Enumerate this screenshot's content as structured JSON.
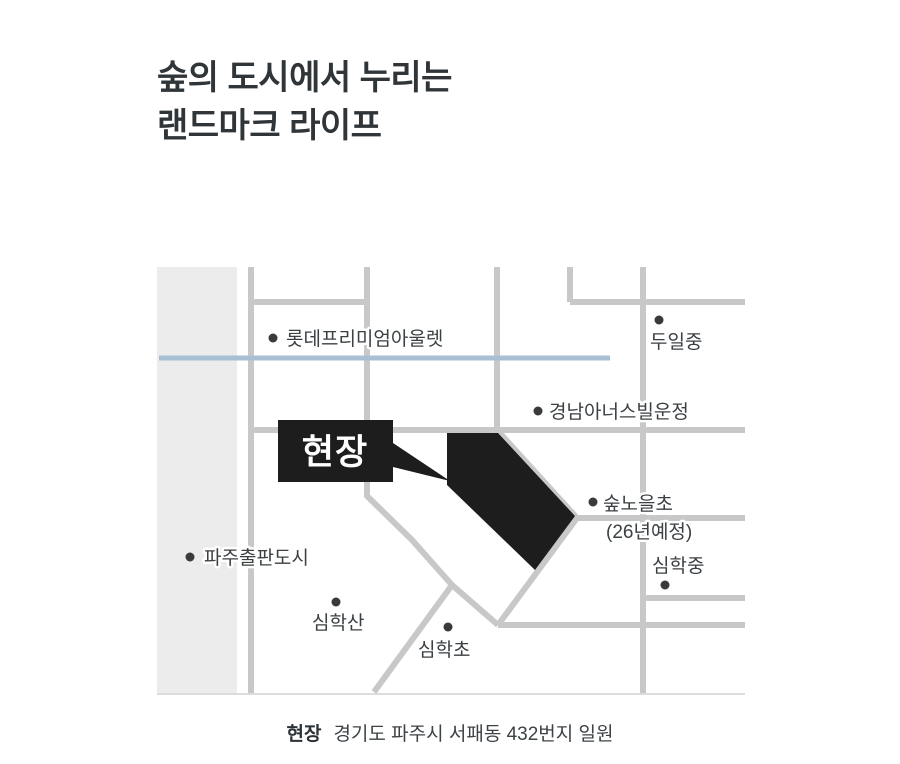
{
  "headline": {
    "line1": "숲의 도시에서 누리는",
    "line2": "랜드마크 라이프"
  },
  "map": {
    "site_flag_label": "현장",
    "labels": {
      "lotte_outlet": "롯데프리미엄아울렛",
      "duil_middle": "두일중",
      "gyeongnam_honorsville": "경남아너스빌운정",
      "supnoeul_elem_line1": "숲노을초",
      "supnoeul_elem_line2": "(26년예정)",
      "simhak_middle": "심학중",
      "paju_publishing_city": "파주출판도시",
      "simhaksan": "심학산",
      "simhak_elem": "심학초"
    },
    "colors": {
      "road": "#c8c8c8",
      "river": "#a9bfd3",
      "left_strip": "#ececec",
      "site_fill": "#1d1d1d",
      "label_text": "#3b4043",
      "dot": "#3a3a3a"
    }
  },
  "caption": {
    "prefix": "현장",
    "address": "경기도 파주시 서패동 432번지 일원"
  }
}
